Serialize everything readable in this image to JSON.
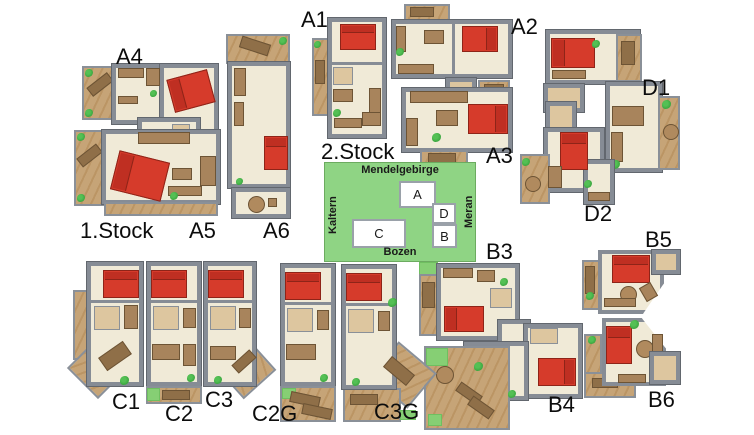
{
  "floors": {
    "first": "1.Stock",
    "second": "2.Stock"
  },
  "apartments": {
    "a1": "A1",
    "a2": "A2",
    "a3": "A3",
    "a4": "A4",
    "a5": "A5",
    "a6": "A6",
    "b3": "B3",
    "b4": "B4",
    "b5": "B5",
    "b6": "B6",
    "c1": "C1",
    "c2": "C2",
    "c3": "C3",
    "c2g": "C2G",
    "c3g": "C3G",
    "d1": "D1",
    "d2": "D2"
  },
  "map": {
    "top_label": "Mendelgebirge",
    "bottom_label": "Bozen",
    "left_label": "Kaltern",
    "right_label": "Meran",
    "buildings": {
      "a": "A",
      "b": "B",
      "c": "C",
      "d": "D"
    }
  },
  "colors": {
    "background": "#ffffff",
    "wall_gray": "#868c95",
    "floor_cream": "#f0ead7",
    "bath_beige": "#ddc69f",
    "terrace_tan": "#c6a477",
    "furniture_brown": "#a8845c",
    "bed_red": "#d63b2b",
    "plant_green": "#3fae3f",
    "map_green": "#8fd484"
  }
}
